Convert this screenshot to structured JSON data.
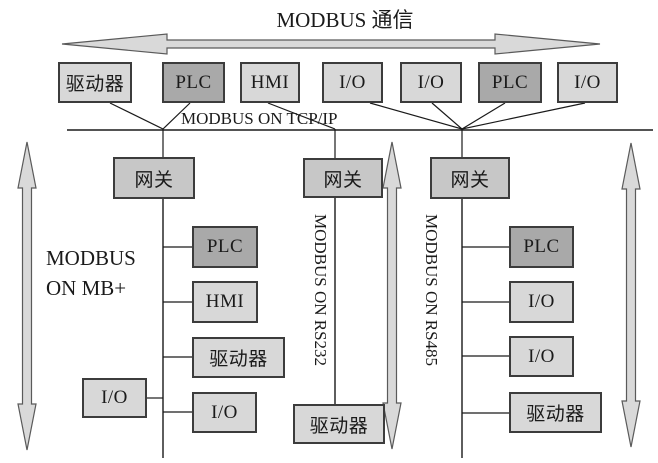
{
  "title": "MODBUS 通信",
  "tcpip_label": "MODBUS ON TCP/IP",
  "top_row": [
    "驱动器",
    "PLC",
    "HMI",
    "I/O",
    "I/O",
    "PLC",
    "I/O"
  ],
  "gateways": [
    "网关",
    "网关",
    "网关"
  ],
  "left_branch": {
    "label": "MODBUS ON MB+",
    "nodes": [
      "PLC",
      "HMI",
      "驱动器",
      "I/O",
      "I/O"
    ]
  },
  "middle_branch": {
    "label": "MODBUS ON RS232",
    "nodes": [
      "驱动器"
    ]
  },
  "right_branch": {
    "label": "MODBUS ON RS485",
    "nodes": [
      "PLC",
      "I/O",
      "I/O",
      "驱动器"
    ]
  },
  "colors": {
    "node_light": "#d8d8d8",
    "node_dark": "#a9a9a9",
    "gateway": "#c7c7c7",
    "border": "#3c3c3c",
    "line": "#1a1a1a",
    "arrow_fill": "#d9d9d9",
    "arrow_outline": "#5a5a5a"
  }
}
